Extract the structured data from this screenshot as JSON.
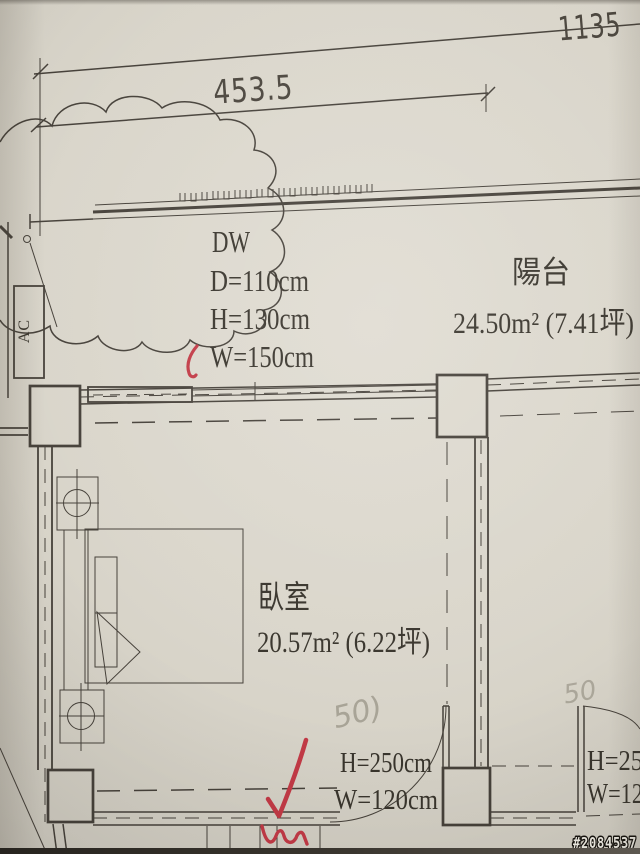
{
  "photo": {
    "watermark": "#2084537"
  },
  "dimensions": {
    "total_width": "1135",
    "balcony_width": "453.5"
  },
  "window_spec": {
    "title": "DW",
    "depth": "D=110cm",
    "height": "H=130cm",
    "width": "W=150cm"
  },
  "rooms": {
    "balcony": {
      "name": "陽台",
      "area": "24.50m² (7.41坪)"
    },
    "bedroom": {
      "name": "臥室",
      "area": "20.57m² (6.22坪)"
    }
  },
  "doors": {
    "bedroom_door": {
      "height": "H=250cm",
      "width": "W=120cm"
    },
    "right_door": {
      "height": "H=25",
      "width": "W=12"
    }
  },
  "equipment": {
    "ac_label": "AC"
  },
  "annotations": {
    "handwritten_left": "50)",
    "handwritten_right": "50"
  },
  "colors": {
    "paper": "#d9d5ca",
    "ink": "#46413a",
    "red_pen": "#c23a46",
    "pencil": "#827d6f"
  }
}
